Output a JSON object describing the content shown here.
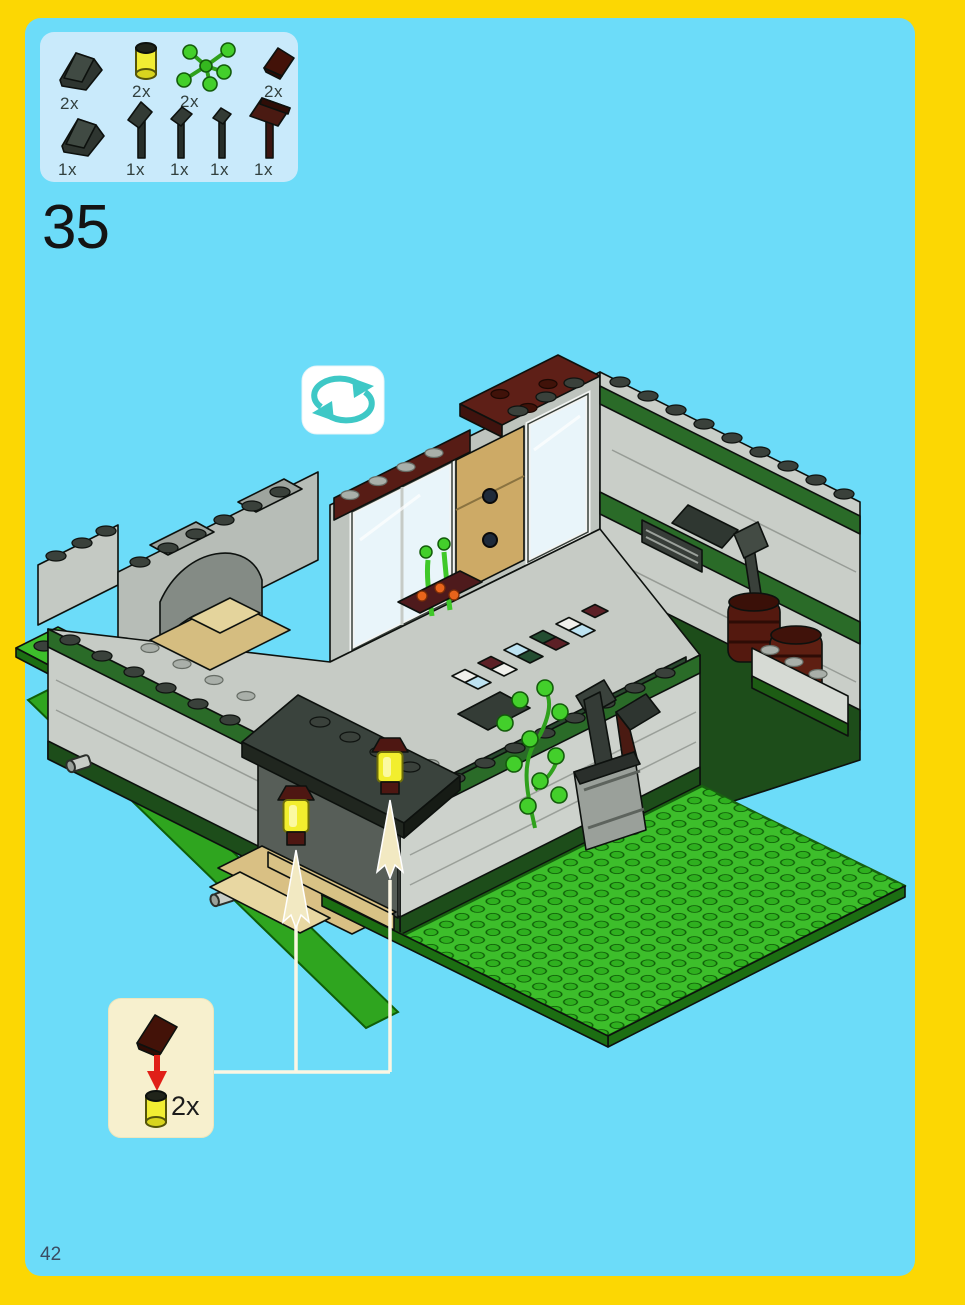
{
  "page": {
    "step_number": "35",
    "page_number": "42"
  },
  "parts_box": {
    "items": [
      {
        "part": "dark-gray-slope-2x2",
        "qty": "2x"
      },
      {
        "part": "trans-yellow-round-brick",
        "qty": "2x"
      },
      {
        "part": "bright-green-plant-leaves",
        "qty": "2x"
      },
      {
        "part": "dark-red-slope-1x2",
        "qty": "2x"
      },
      {
        "part": "dark-gray-slope-2x2",
        "qty": "1x"
      },
      {
        "part": "shovel-tool",
        "qty": "1x"
      },
      {
        "part": "spade-tool",
        "qty": "1x"
      },
      {
        "part": "hammer-tool",
        "qty": "1x"
      },
      {
        "part": "sledgehammer-tool",
        "qty": "1x"
      }
    ]
  },
  "callout": {
    "qty": "2x",
    "top_part": "dark-red-slope",
    "bottom_part": "trans-yellow-round-brick"
  },
  "rotate_icon": "rotate-model",
  "colors": {
    "page_background": "#6CDCF9",
    "border": "#FCD703",
    "parts_box_background": "#C9EAFB",
    "callout_background": "#F7F0CE",
    "baseplate_green": "#3DBE2B",
    "stripe_green": "#2A6B28",
    "dark_red": "#551B14",
    "lamp_yellow": "#F2EE2E",
    "wall_gray": "#C9CEC8",
    "awning_dark": "#333B35",
    "teal_arrows": "#3EC8C6",
    "guide_arrow_cream": "#F2E9C2",
    "red_arrow": "#E02018"
  }
}
